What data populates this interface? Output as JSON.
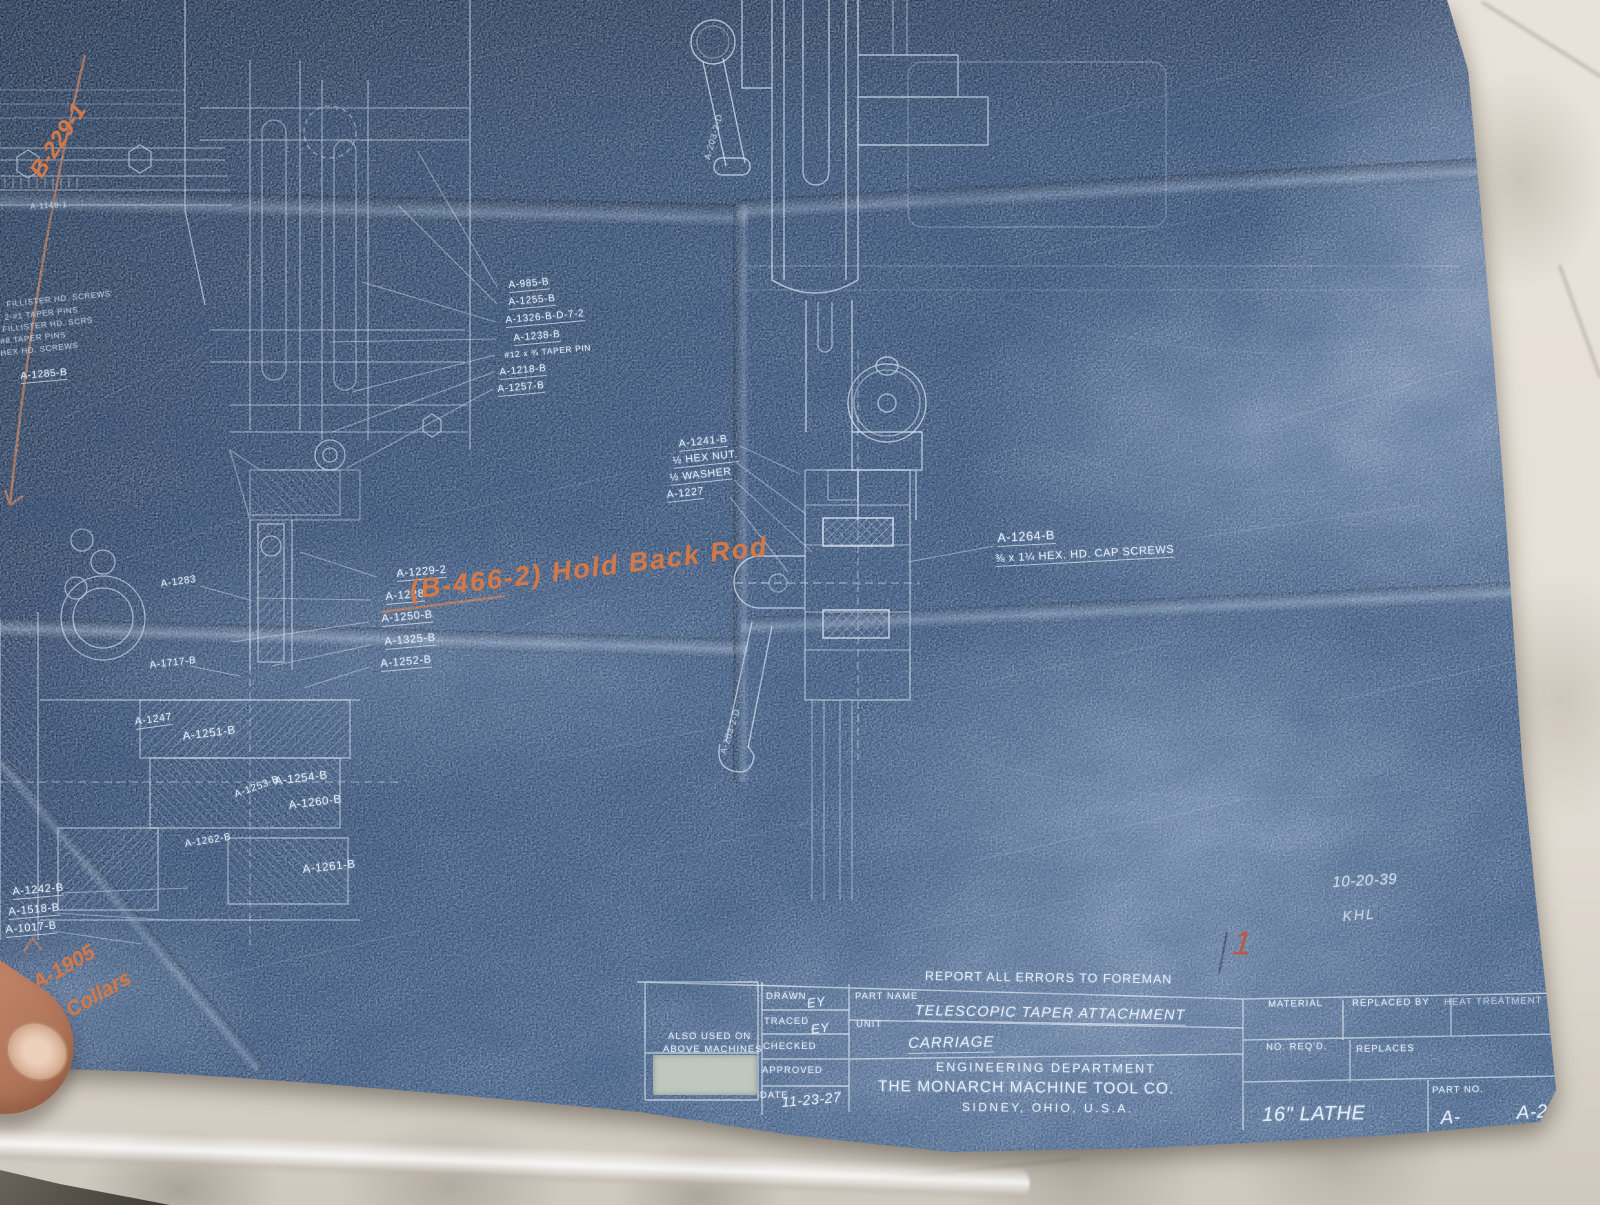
{
  "colors": {
    "sheet_blue": "#2e4a72",
    "line_white": "#e3edf9",
    "note_orange": "#d2794a",
    "marble": "#e6dfd7"
  },
  "notes": {
    "top_left": "B-229-1",
    "hold_back": "(B-466-2) Hold Back Rod",
    "collars_1": "A-1905",
    "collars_2": "Collars",
    "date_note": "10-20-39",
    "initials": "KHL",
    "red_mark": "1"
  },
  "labels": {
    "upper_list": [
      "A-985-B",
      "A-1255-B",
      "A-1326-B-D-7-2",
      "A-1238-B",
      "#12 x ¾ TAPER PIN",
      "A-1218-B",
      "A-1257-B"
    ],
    "left_edge_list": [
      "FILLISTER HD. SCREWS",
      "2-#1 TAPER PINS",
      "FILLISTER HD. SCRS",
      "#8 TAPER PINS",
      "HEX HD. SCREWS"
    ],
    "left_edge_part": "A-1285-B",
    "tiny_part": "A-1148-1",
    "mid_list": [
      "A-1229-2",
      "A-1228",
      "A-1250-B",
      "A-1325-B",
      "A-1252-B"
    ],
    "nut_list": [
      "A-1241-B",
      "½ HEX NUT.",
      "½ WASHER",
      "A-1227"
    ],
    "cap_screw_part": "A-1264-B",
    "cap_screw_note": "⅜ x 1¼ HEX. HD. CAP SCREWS",
    "section": [
      "A-1283",
      "A-1717-B",
      "A-1247",
      "A-1251-B",
      "A-1254-B",
      "A-1253-B",
      "A-1260-B",
      "A-1262-B",
      "A-1261-B"
    ],
    "bottom_left": [
      "A-1242-B",
      "A-1518-B",
      "A-1017-B"
    ],
    "handle": "A-203-2-D"
  },
  "tb": {
    "report": "REPORT ALL ERRORS TO FOREMAN",
    "also_used_1": "ALSO USED ON",
    "also_used_2": "ABOVE MACHINES",
    "drawn": "DRAWN",
    "drawn_by": "EY",
    "traced": "TRACED",
    "traced_by": "EY",
    "checked": "CHECKED",
    "approved": "APPROVED",
    "date": "DATE",
    "date_value": "11-23-27",
    "part_name_label": "PART NAME",
    "part_name": "TELESCOPIC TAPER ATTACHMENT",
    "unit_label": "UNIT",
    "unit": "CARRIAGE",
    "dept": "ENGINEERING DEPARTMENT",
    "company": "THE MONARCH MACHINE TOOL CO.",
    "city": "SIDNEY, OHIO, U.S.A.",
    "material": "MATERIAL",
    "replaced_by": "REPLACED BY",
    "heat": "HEAT TREATMENT",
    "no_reqd": "NO. REQ'D.",
    "replaces": "REPLACES",
    "part_no_label": "PART NO.",
    "machine": "16\" LATHE",
    "part_no_a": "A-",
    "part_no": "A-2"
  }
}
